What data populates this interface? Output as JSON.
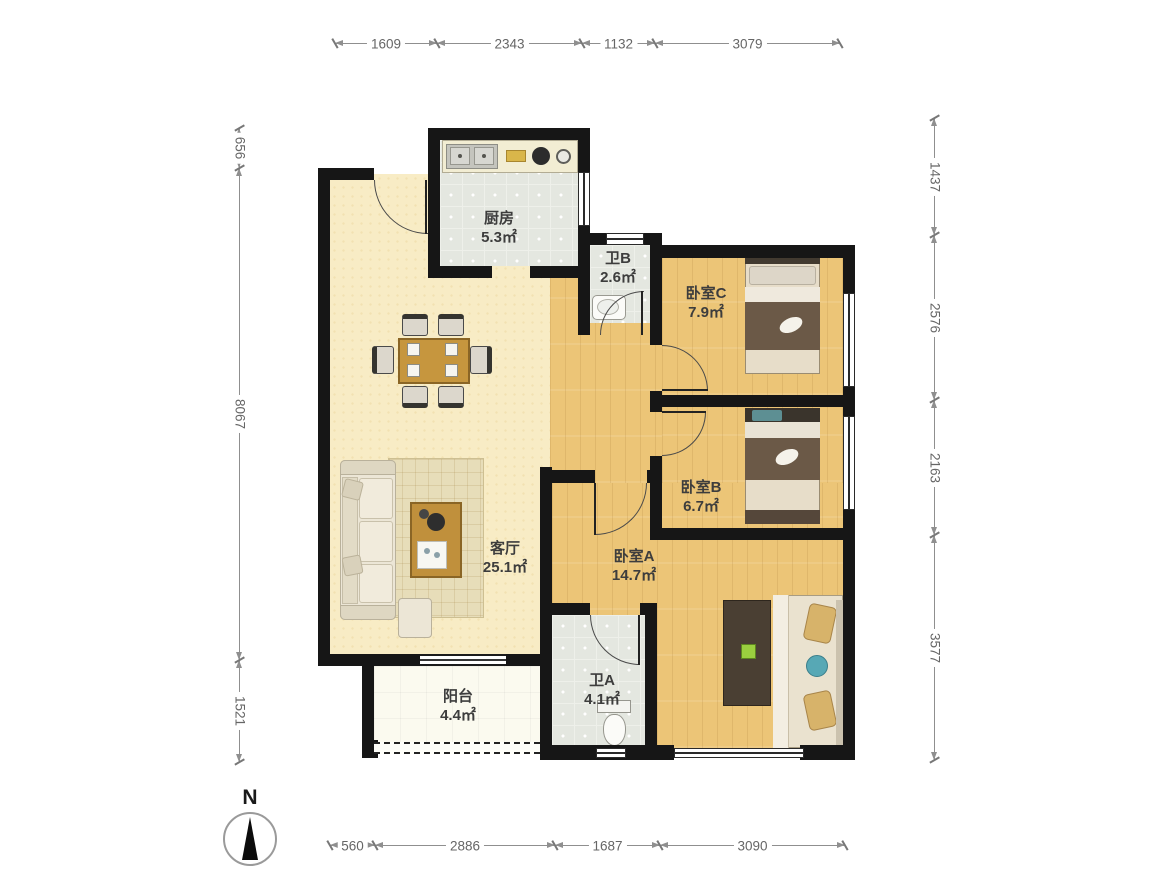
{
  "compass": {
    "label": "N"
  },
  "dimensions": {
    "top": [
      "1609",
      "2343",
      "1132",
      "3079"
    ],
    "bottom": [
      "560",
      "2886",
      "1687",
      "3090"
    ],
    "left": [
      "656",
      "8067",
      "1521"
    ],
    "right": [
      "1437",
      "2576",
      "2163",
      "3577"
    ]
  },
  "rooms": [
    {
      "name": "厨房",
      "area": "5.3㎡"
    },
    {
      "name": "卫B",
      "area": "2.6㎡"
    },
    {
      "name": "卧室C",
      "area": "7.9㎡"
    },
    {
      "name": "卧室B",
      "area": "6.7㎡"
    },
    {
      "name": "客厅",
      "area": "25.1㎡"
    },
    {
      "name": "卧室A",
      "area": "14.7㎡"
    },
    {
      "name": "阳台",
      "area": "4.4㎡"
    },
    {
      "name": "卫A",
      "area": "4.1㎡"
    }
  ],
  "colors": {
    "wall": "#161616",
    "wood": "#ecc577",
    "tile": "#e4e7e0",
    "living": "#f8ecc5",
    "balcony": "#fbfaef"
  }
}
